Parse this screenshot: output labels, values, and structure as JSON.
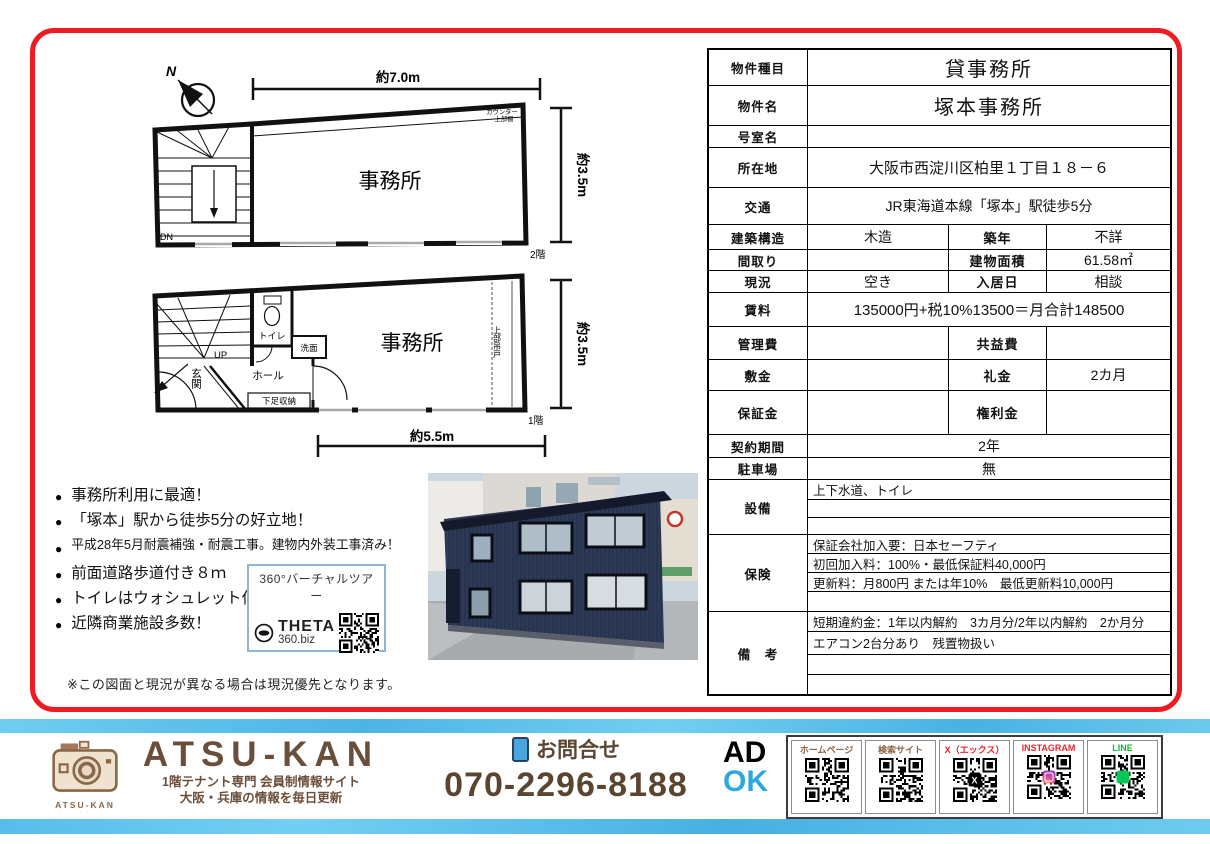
{
  "plans": {
    "compass_n": "N",
    "f2": {
      "dim_top": "約7.0m",
      "dim_right": "約3.5m",
      "room": "事務所",
      "counter1": "カウンター",
      "counter2": "上部棚",
      "dn": "DN",
      "floor": "2階"
    },
    "f1": {
      "dim_right": "約3.5m",
      "dim_bottom": "約5.5m",
      "room": "事務所",
      "toilet": "トイレ",
      "up": "UP",
      "wash": "洗面",
      "hall": "ホール",
      "entrance": "玄関",
      "shoe": "下足収納",
      "hang": "上部吊戸",
      "floor": "1階"
    }
  },
  "highlights": [
    {
      "text": "事務所利用に最適！",
      "small": false
    },
    {
      "text": "「塚本」駅から徒歩5分の好立地！",
      "small": false
    },
    {
      "text": "平成28年5月耐震補強・耐震工事。建物内外装工事済み！",
      "small": true
    },
    {
      "text": "前面道路歩道付き８ｍ",
      "small": false
    },
    {
      "text": "トイレはウォシュレット付き",
      "small": false
    },
    {
      "text": "近隣商業施設多数！",
      "small": false
    }
  ],
  "vr": {
    "title": "360°バーチャルツアー",
    "brand": "THETA",
    "sub": "360.biz"
  },
  "note": "※この図面と現況が異なる場合は現況優先となります。",
  "spec": {
    "rows": [
      {
        "label": "物件種目",
        "value": "貸事務所",
        "size": "xl"
      },
      {
        "label": "物件名",
        "value": "塚本事務所",
        "size": "xl"
      },
      {
        "label": "号室名",
        "value": ""
      },
      {
        "label": "所在地",
        "value": "大阪市西淀川区柏里１丁目１８－６",
        "size": "lg"
      },
      {
        "label": "交通",
        "value": "JR東海道本線「塚本」駅徒歩5分"
      },
      {
        "label": "建築構造",
        "value": "木造",
        "label2": "築年",
        "value2": "不詳"
      },
      {
        "label": "間取り",
        "value": "",
        "label2": "建物面積",
        "value2": "61.58㎡"
      },
      {
        "label": "現況",
        "value": "空き",
        "label2": "入居日",
        "value2": "相談"
      },
      {
        "label": "賃料",
        "value": "135000円+税10%13500＝月合計148500",
        "size": "lg"
      },
      {
        "label": "管理費",
        "value": "",
        "label2": "共益費",
        "value2": ""
      },
      {
        "label": "敷金",
        "value": "",
        "label2": "礼金",
        "value2": "2カ月"
      },
      {
        "label": "保証金",
        "value": "",
        "label2": "権利金",
        "value2": ""
      },
      {
        "label": "契約期間",
        "value": "2年"
      },
      {
        "label": "駐車場",
        "value": "無"
      },
      {
        "label": "設備",
        "lines": [
          "上下水道、トイレ",
          "",
          ""
        ]
      },
      {
        "label": "保険",
        "lines": [
          "保証会社加入要：日本セーフティ",
          "初回加入料：100%・最低保証料40,000円",
          "更新料：月800円 または年10%　最低更新料10,000円",
          ""
        ]
      },
      {
        "label": "備　考",
        "lines": [
          "短期違約金：1年以内解約　3カ月分/2年以内解約　2か月分",
          "エアコン2台分あり　残置物扱い",
          "",
          ""
        ]
      }
    ]
  },
  "footer": {
    "brand": "ATSU-KAN",
    "brand_sub1": "1階テナント専門 会員制情報サイト",
    "brand_sub2": "大阪・兵庫の情報を毎日更新",
    "logo_caption": "ATSU-KAN",
    "contact_label": "お問合せ",
    "phone": "070-2296-8188",
    "ad": "AD",
    "ok": "OK",
    "qr": [
      {
        "label": "ホームページ",
        "color": "#8b6347",
        "logo": ""
      },
      {
        "label": "検索サイト",
        "color": "#8b6347",
        "logo": ""
      },
      {
        "label": "X（エックス）",
        "color": "#e8262d",
        "logo": "x",
        "logo_glyph": "X"
      },
      {
        "label": "INSTAGRAM",
        "color": "#e8262d",
        "logo": "instagram"
      },
      {
        "label": "LINE",
        "color": "#11b934",
        "logo": "line"
      }
    ]
  },
  "colors": {
    "accent_red": "#ed1c24",
    "footer_blue": "#55bee9",
    "brand_brown": "#6b4e39",
    "ok_blue": "#2ea7e0"
  }
}
